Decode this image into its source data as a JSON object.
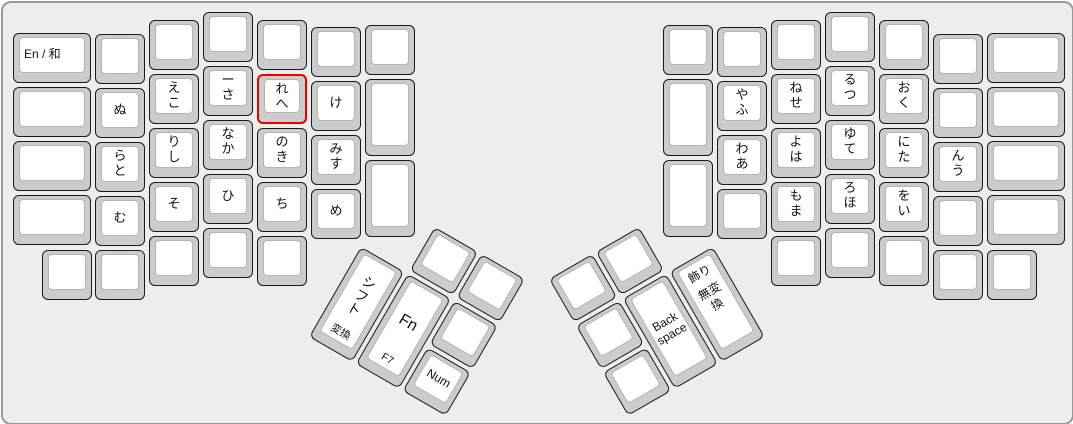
{
  "app": {
    "title": "Split ergonomic keyboard layout with Japanese kana legends",
    "canvas": {
      "width": 1073,
      "height": 424
    }
  },
  "colors": {
    "page_bg": "#ffffff",
    "canvas_bg": "#ededed",
    "canvas_border": "#999999",
    "keycap_side": "#cccccc",
    "keycap_face": "#ffffff",
    "keycap_border": "#1a1a1a",
    "selection_border": "#e60000",
    "legend_text": "#111111"
  },
  "selection": {
    "selected_key": "key-re-he",
    "selected_legends": "れ / へ"
  },
  "keyboard": {
    "unit_px": 54,
    "groups": [
      {
        "name": "left-main",
        "x": 0,
        "y": 0,
        "rot": 0
      },
      {
        "name": "right-main",
        "x": 0,
        "y": 0,
        "rot": 0
      },
      {
        "name": "left-thumb",
        "x": 384.5,
        "y": 197,
        "rot": 30
      },
      {
        "name": "right-thumb",
        "x": 545.8,
        "y": 275.6,
        "rot": -30
      }
    ],
    "keys": [
      {
        "group": "left-main",
        "name": "key-en-wa",
        "x": 10,
        "y": 30,
        "w": 78,
        "layout": "left",
        "center": "En / 和",
        "fs": 12
      },
      {
        "group": "left-main",
        "name": "key-blank",
        "x": 10,
        "y": 84,
        "w": 78
      },
      {
        "group": "left-main",
        "name": "key-blank",
        "x": 10,
        "y": 138,
        "w": 78
      },
      {
        "group": "left-main",
        "name": "key-blank",
        "x": 10,
        "y": 192,
        "w": 78
      },
      {
        "group": "left-main",
        "name": "key-blank",
        "x": 92,
        "y": 31
      },
      {
        "group": "left-main",
        "name": "key-nu",
        "x": 92,
        "y": 85,
        "center": "ぬ"
      },
      {
        "group": "left-main",
        "name": "key-ra-to",
        "x": 92,
        "y": 139,
        "layout": "dual",
        "top": "ら",
        "bottom": "と"
      },
      {
        "group": "left-main",
        "name": "key-mu",
        "x": 92,
        "y": 193,
        "center": "む"
      },
      {
        "group": "left-main",
        "name": "key-blank",
        "x": 92,
        "y": 247
      },
      {
        "group": "left-main",
        "name": "key-blank",
        "x": 146,
        "y": 17
      },
      {
        "group": "left-main",
        "name": "key-e-ko",
        "x": 146,
        "y": 71,
        "layout": "dual",
        "top": "え",
        "bottom": "こ"
      },
      {
        "group": "left-main",
        "name": "key-ri-shi",
        "x": 146,
        "y": 125,
        "layout": "dual",
        "top": "り",
        "bottom": "し"
      },
      {
        "group": "left-main",
        "name": "key-so",
        "x": 146,
        "y": 179,
        "center": "そ"
      },
      {
        "group": "left-main",
        "name": "key-blank",
        "x": 146,
        "y": 233
      },
      {
        "group": "left-main",
        "name": "key-blank",
        "x": 200,
        "y": 9
      },
      {
        "group": "left-main",
        "name": "key-onbiki-sa",
        "x": 200,
        "y": 63,
        "layout": "dual",
        "top": "ー",
        "bottom": "さ"
      },
      {
        "group": "left-main",
        "name": "key-na-ka",
        "x": 200,
        "y": 117,
        "layout": "dual",
        "top": "な",
        "bottom": "か"
      },
      {
        "group": "left-main",
        "name": "key-hi",
        "x": 200,
        "y": 171,
        "center": "ひ"
      },
      {
        "group": "left-main",
        "name": "key-blank",
        "x": 200,
        "y": 225
      },
      {
        "group": "left-main",
        "name": "key-blank",
        "x": 254,
        "y": 17
      },
      {
        "group": "left-main",
        "name": "key-re-he",
        "x": 254,
        "y": 71,
        "layout": "dual",
        "top": "れ",
        "bottom": "へ",
        "selected": true
      },
      {
        "group": "left-main",
        "name": "key-no-ki",
        "x": 254,
        "y": 125,
        "layout": "dual",
        "top": "の",
        "bottom": "き"
      },
      {
        "group": "left-main",
        "name": "key-chi",
        "x": 254,
        "y": 179,
        "center": "ち"
      },
      {
        "group": "left-main",
        "name": "key-blank",
        "x": 254,
        "y": 233
      },
      {
        "group": "left-main",
        "name": "key-blank",
        "x": 308,
        "y": 24
      },
      {
        "group": "left-main",
        "name": "key-ke",
        "x": 308,
        "y": 78,
        "center": "け"
      },
      {
        "group": "left-main",
        "name": "key-mi-su",
        "x": 308,
        "y": 132,
        "layout": "dual",
        "top": "み",
        "bottom": "す"
      },
      {
        "group": "left-main",
        "name": "key-me",
        "x": 308,
        "y": 186,
        "center": "め"
      },
      {
        "group": "left-main",
        "name": "key-blank",
        "x": 362,
        "y": 22
      },
      {
        "group": "left-main",
        "name": "key-blank",
        "x": 362,
        "y": 76,
        "h": 77
      },
      {
        "group": "left-main",
        "name": "key-blank",
        "x": 362,
        "y": 157,
        "h": 77
      },
      {
        "group": "left-main",
        "name": "key-blank",
        "x": 39,
        "y": 247
      },
      {
        "group": "right-main",
        "name": "key-blank",
        "x": 660,
        "y": 22
      },
      {
        "group": "right-main",
        "name": "key-blank",
        "x": 660,
        "y": 76,
        "h": 77
      },
      {
        "group": "right-main",
        "name": "key-blank",
        "x": 660,
        "y": 157,
        "h": 77
      },
      {
        "group": "right-main",
        "name": "key-blank",
        "x": 714,
        "y": 24
      },
      {
        "group": "right-main",
        "name": "key-ya-fu",
        "x": 714,
        "y": 78,
        "layout": "dual",
        "top": "や",
        "bottom": "ふ"
      },
      {
        "group": "right-main",
        "name": "key-wa-a",
        "x": 714,
        "y": 132,
        "layout": "dual",
        "top": "わ",
        "bottom": "あ"
      },
      {
        "group": "right-main",
        "name": "key-blank",
        "x": 714,
        "y": 186
      },
      {
        "group": "right-main",
        "name": "key-blank",
        "x": 768,
        "y": 17
      },
      {
        "group": "right-main",
        "name": "key-ne-se",
        "x": 768,
        "y": 71,
        "layout": "dual",
        "top": "ね",
        "bottom": "せ"
      },
      {
        "group": "right-main",
        "name": "key-yo-ha",
        "x": 768,
        "y": 125,
        "layout": "dual",
        "top": "よ",
        "bottom": "は"
      },
      {
        "group": "right-main",
        "name": "key-mo-ma",
        "x": 768,
        "y": 179,
        "layout": "dual",
        "top": "も",
        "bottom": "ま"
      },
      {
        "group": "right-main",
        "name": "key-blank",
        "x": 768,
        "y": 233
      },
      {
        "group": "right-main",
        "name": "key-blank",
        "x": 822,
        "y": 9
      },
      {
        "group": "right-main",
        "name": "key-ru-tsu",
        "x": 822,
        "y": 63,
        "layout": "dual",
        "top": "る",
        "bottom": "つ"
      },
      {
        "group": "right-main",
        "name": "key-yu-te",
        "x": 822,
        "y": 117,
        "layout": "dual",
        "top": "ゆ",
        "bottom": "て"
      },
      {
        "group": "right-main",
        "name": "key-ro-ho",
        "x": 822,
        "y": 171,
        "layout": "dual",
        "top": "ろ",
        "bottom": "ほ"
      },
      {
        "group": "right-main",
        "name": "key-blank",
        "x": 822,
        "y": 225
      },
      {
        "group": "right-main",
        "name": "key-blank",
        "x": 876,
        "y": 17
      },
      {
        "group": "right-main",
        "name": "key-o-ku",
        "x": 876,
        "y": 71,
        "layout": "dual",
        "top": "お",
        "bottom": "く"
      },
      {
        "group": "right-main",
        "name": "key-ni-ta",
        "x": 876,
        "y": 125,
        "layout": "dual",
        "top": "に",
        "bottom": "た"
      },
      {
        "group": "right-main",
        "name": "key-wo-i",
        "x": 876,
        "y": 179,
        "layout": "dual",
        "top": "を",
        "bottom": "い"
      },
      {
        "group": "right-main",
        "name": "key-blank",
        "x": 876,
        "y": 233
      },
      {
        "group": "right-main",
        "name": "key-blank",
        "x": 930,
        "y": 31
      },
      {
        "group": "right-main",
        "name": "key-blank",
        "x": 930,
        "y": 85
      },
      {
        "group": "right-main",
        "name": "key-n-u",
        "x": 930,
        "y": 139,
        "layout": "dual",
        "top": "ん",
        "bottom": "う"
      },
      {
        "group": "right-main",
        "name": "key-blank",
        "x": 930,
        "y": 193
      },
      {
        "group": "right-main",
        "name": "key-blank",
        "x": 930,
        "y": 247
      },
      {
        "group": "right-main",
        "name": "key-blank",
        "x": 984,
        "y": 30,
        "w": 78
      },
      {
        "group": "right-main",
        "name": "key-blank",
        "x": 984,
        "y": 84,
        "w": 78
      },
      {
        "group": "right-main",
        "name": "key-blank",
        "x": 984,
        "y": 138,
        "w": 78
      },
      {
        "group": "right-main",
        "name": "key-blank",
        "x": 984,
        "y": 192,
        "w": 78
      },
      {
        "group": "right-main",
        "name": "key-blank",
        "x": 984,
        "y": 247
      },
      {
        "group": "left-thumb",
        "name": "key-blank",
        "x": 54,
        "y": 0
      },
      {
        "group": "left-thumb",
        "name": "key-blank",
        "x": 108,
        "y": 0
      },
      {
        "group": "left-thumb",
        "name": "key-shift-henkan",
        "x": 0,
        "y": 54,
        "h": 104,
        "layout": "shift",
        "center": "シフト",
        "bottom": "変換"
      },
      {
        "group": "left-thumb",
        "name": "key-fn-f7",
        "x": 54,
        "y": 54,
        "h": 104,
        "layout": "fn",
        "center": "Fn",
        "bottom": "F7"
      },
      {
        "group": "left-thumb",
        "name": "key-blank",
        "x": 108,
        "y": 54
      },
      {
        "group": "left-thumb",
        "name": "key-num",
        "x": 108,
        "y": 108,
        "center": "Num",
        "fs": 12
      },
      {
        "group": "right-thumb",
        "name": "key-blank",
        "x": 0,
        "y": 0
      },
      {
        "group": "right-thumb",
        "name": "key-blank",
        "x": 54,
        "y": 0
      },
      {
        "group": "right-thumb",
        "name": "key-blank",
        "x": 0,
        "y": 54
      },
      {
        "group": "right-thumb",
        "name": "key-blank",
        "x": 0,
        "y": 108
      },
      {
        "group": "right-thumb",
        "name": "key-backspace",
        "x": 54,
        "y": 54,
        "h": 104,
        "center": "Back space",
        "fs": 12
      },
      {
        "group": "right-thumb",
        "name": "key-kazari-muhenkan",
        "x": 108,
        "y": 54,
        "h": 104,
        "layout": "stack",
        "top": "飾り",
        "bottom": "無変換"
      }
    ]
  }
}
